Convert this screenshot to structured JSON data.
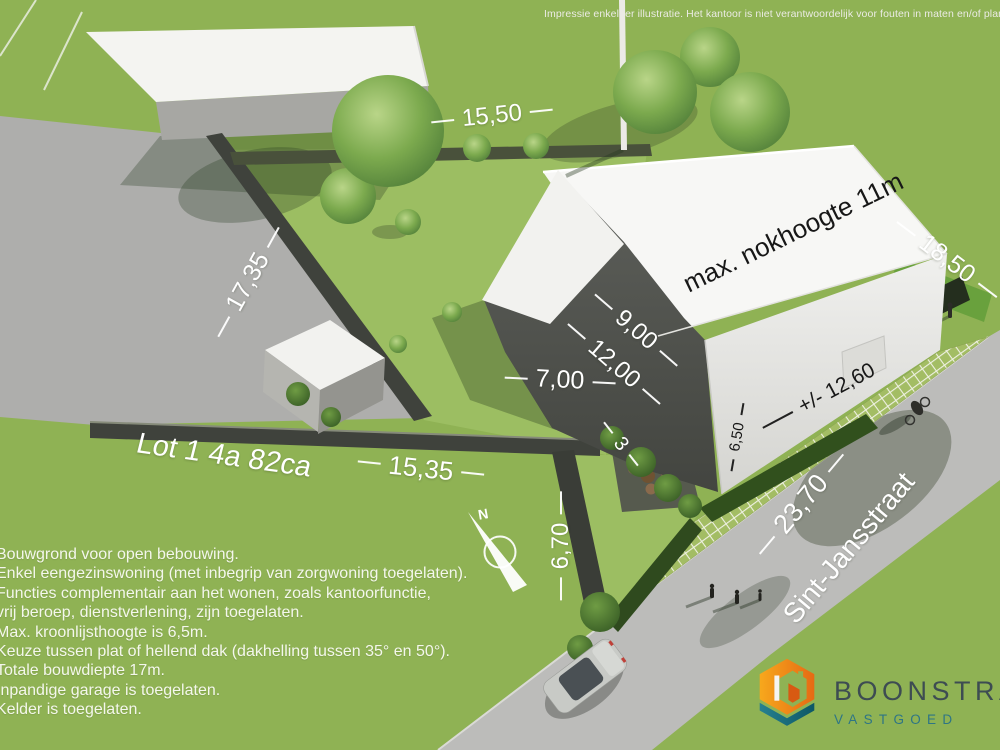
{
  "disclaimer": "Impressie enkel ter illustratie. Het kantoor is niet verantwoordelijk voor fouten in maten en/of plannen",
  "plot": {
    "lot_label": "Lot 1  4a 82ca",
    "street_name": "Sint-Jansstraat",
    "north_label": "N"
  },
  "dimensions": {
    "top_boundary": "15,50",
    "left_boundary": "17,35",
    "right_boundary": "18,50",
    "front_boundary": "15,35",
    "side_strip": "3",
    "driveway_depth": "6,70",
    "street_frontage": "23,70",
    "roof_note": "max. nokhoogte 11m",
    "house_depth_a": "9,00",
    "house_depth_b": "12,00",
    "house_width": "7,00",
    "facade_width": "+/- 12,60",
    "eaves_height": "6,50"
  },
  "regulations": {
    "lines": [
      "Bouwgrond voor open bebouwing.",
      "Enkel eengezinswoning (met inbegrip van zorgwoning toegelaten).",
      "Functies complementair aan het wonen, zoals kantoorfunctie,",
      "vrij beroep, dienstverlening, zijn toegelaten.",
      "Max. kroonlijsthoogte is 6,5m.",
      "Keuze tussen plat of hellend dak (dakhelling tussen 35° en 50°).",
      "Totale bouwdiepte 17m.",
      "Inpandige garage is toegelaten.",
      "Kelder is toegelaten."
    ]
  },
  "logo": {
    "name": "BOONSTRA",
    "subtitle": "VASTGOED"
  },
  "colors": {
    "grass": "#8fb254",
    "lot_grass": "#9cbe62",
    "asphalt": "#aeaeac",
    "street": "#bcbcba",
    "wall_dark": "#3f423c",
    "house_white": "#f7f7f5",
    "house_shadow": "#4f514c",
    "logo_orange": "#ef8f1d",
    "logo_teal": "#1f7585",
    "label_white": "#ffffff",
    "label_black": "#171717"
  }
}
